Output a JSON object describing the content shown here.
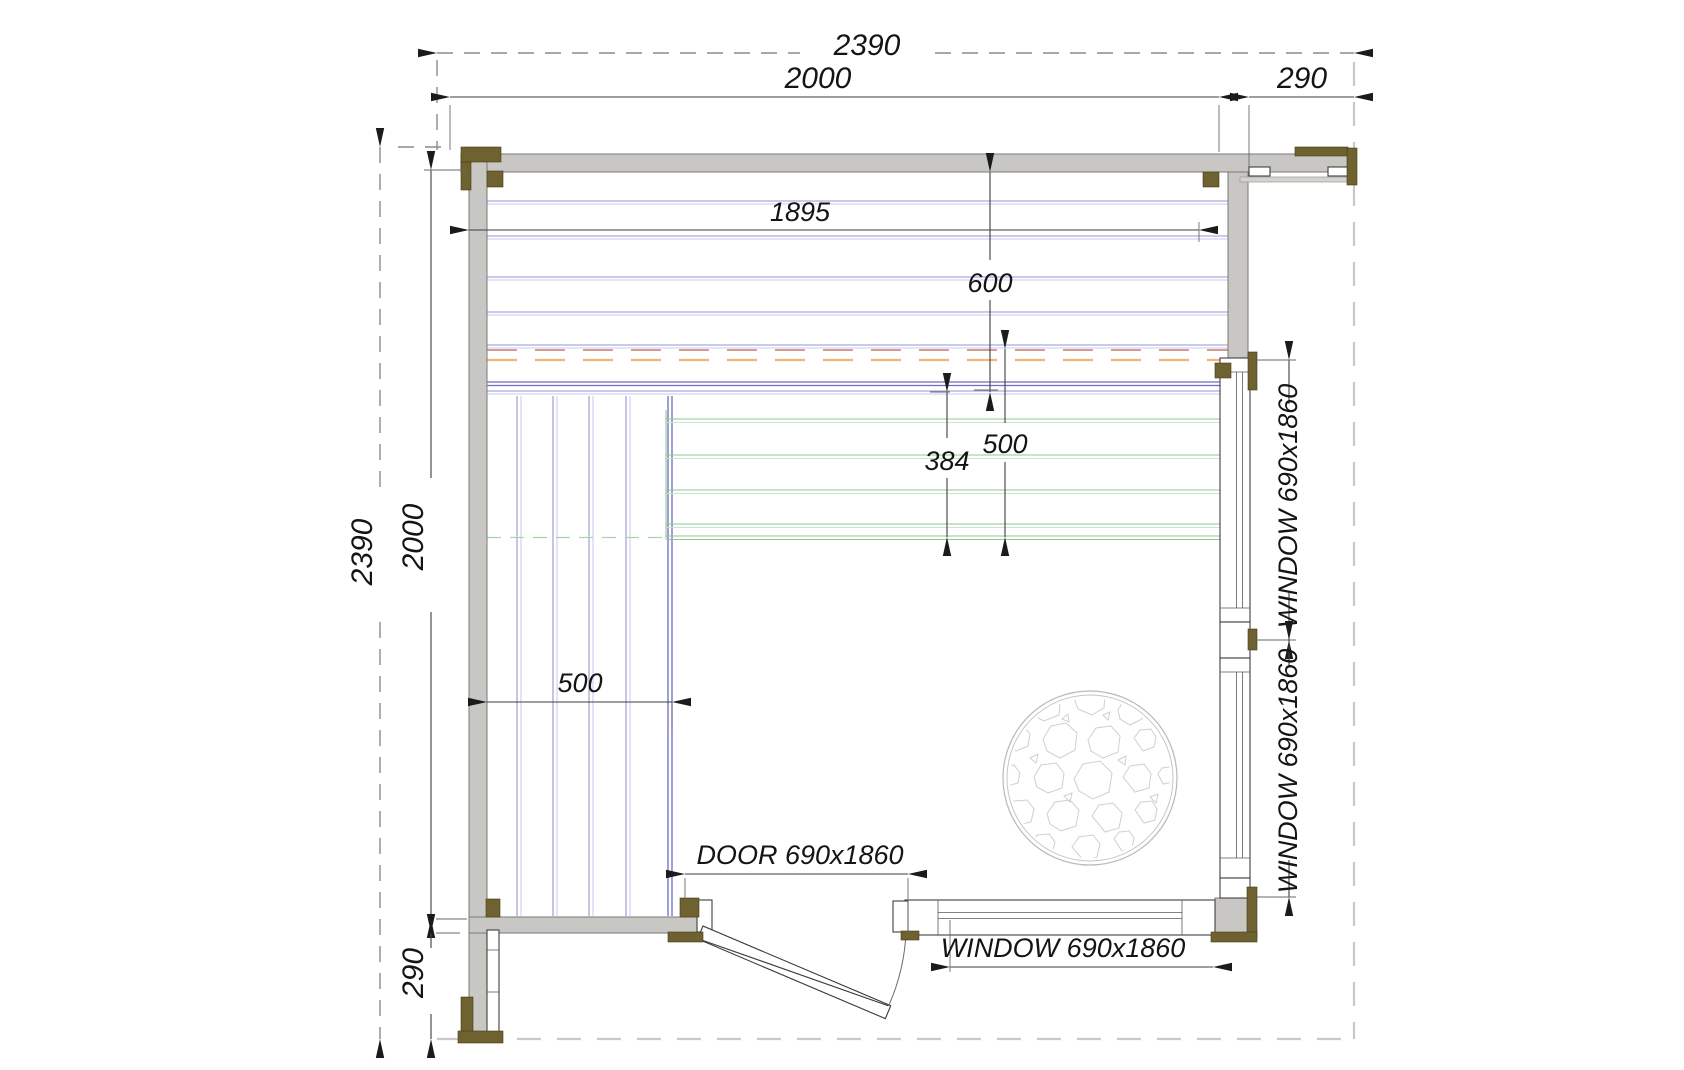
{
  "plan": {
    "dims_top": {
      "overall": "2390",
      "room": "2000",
      "porch": "290"
    },
    "dims_left": {
      "overall": "2390",
      "room": "2000",
      "porch": "290"
    },
    "dims_inner": {
      "bench_length": "1895",
      "bench_depth": "600",
      "clearance": "500",
      "gap": "384",
      "side_bench": "500"
    },
    "openings": {
      "door": "DOOR 690x1860",
      "window_right_upper": "WINDOW 690x1860",
      "window_right_lower": "WINDOW 690x1860",
      "window_bottom": "WINDOW 690x1860"
    }
  },
  "colors": {
    "wall": "#c8c7c3",
    "rail": "#d4d3cf",
    "post": "#6e6230",
    "bench_blue": "#9595d6",
    "bench_blue_dark": "#6d6dc4",
    "bench_green": "#90c890",
    "bench_green_dash": "#a5d6a5",
    "clearance_red": "#d49c92",
    "clearance_orange": "#f2b577",
    "boundary": "#c8c8c8",
    "stone": "#cfcfcf"
  }
}
